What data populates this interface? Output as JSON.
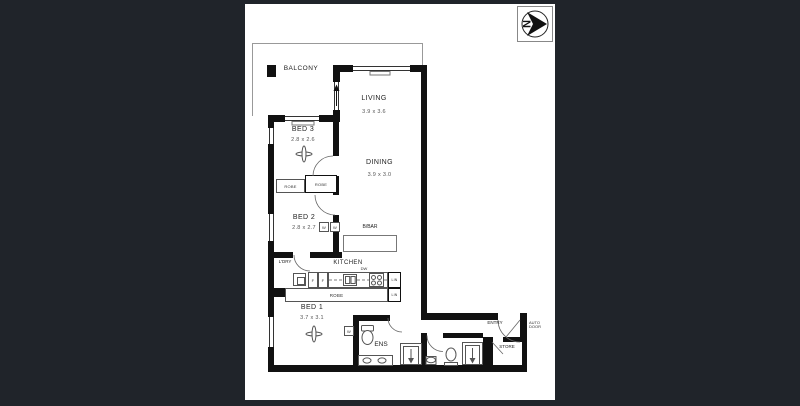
{
  "colors": {
    "background": "#20242a",
    "paper": "#ffffff",
    "wall": "#111111"
  },
  "compass": {
    "north": "N"
  },
  "rooms": {
    "balcony": {
      "label": "BALCONY"
    },
    "living": {
      "label": "LIVING",
      "dims": "3.9 x 3.6"
    },
    "dining": {
      "label": "DINING",
      "dims": "3.9 x 3.0"
    },
    "bed3": {
      "label": "BED 3",
      "dims": "2.8 x 2.6"
    },
    "bed2": {
      "label": "BED 2",
      "dims": "2.8 x 2.7"
    },
    "bed1": {
      "label": "BED 1",
      "dims": "3.7 x 3.1"
    },
    "kitchen": {
      "label": "KITCHEN"
    },
    "laundry": {
      "label": "L'DRY"
    },
    "ensuite": {
      "label": "ENS"
    },
    "entry": {
      "label": "ENTRY"
    },
    "store": {
      "label": "STORE"
    },
    "breakfast_bar": {
      "label": "B/BAR"
    }
  },
  "fixtures": {
    "robe": "ROBE",
    "linen": "LIN",
    "wardrobe": "W",
    "fridge": "F",
    "dishwasher": "DW"
  },
  "annotations": {
    "auto": "AUTO",
    "door": "DOOR"
  }
}
